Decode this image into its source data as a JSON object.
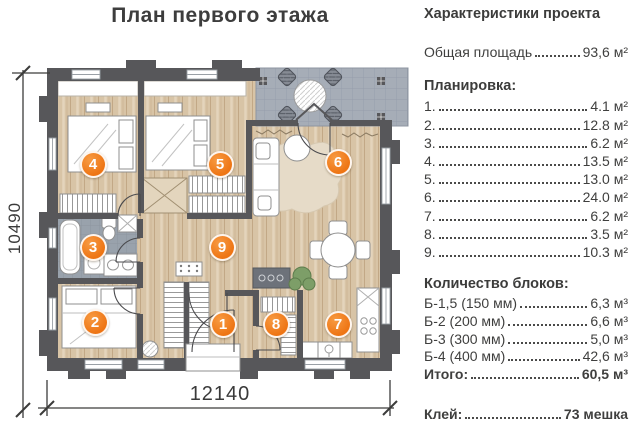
{
  "title": "План первого этажа",
  "colors": {
    "accent_orange": "#ee7b1c",
    "wall_gray": "#57575a",
    "wood_floor": "#d8c4a6",
    "tile_gray": "#9ba4ae",
    "text_dark": "#3c3c3b"
  },
  "plan": {
    "dimensions": {
      "width_label": "12140",
      "height_label": "10490"
    },
    "rooms": [
      {
        "number": "1"
      },
      {
        "number": "2"
      },
      {
        "number": "3"
      },
      {
        "number": "4"
      },
      {
        "number": "5"
      },
      {
        "number": "6"
      },
      {
        "number": "7"
      },
      {
        "number": "8"
      },
      {
        "number": "9"
      }
    ]
  },
  "panel": {
    "header": "Характеристики проекта",
    "total": {
      "label": "Общая площадь",
      "value": "93,6 м²"
    },
    "layout": {
      "header": "Планировка:",
      "items": [
        {
          "label": "1.",
          "value": "4.1 м²"
        },
        {
          "label": "2.",
          "value": "12.8 м²"
        },
        {
          "label": "3.",
          "value": "6.2 м²"
        },
        {
          "label": "4.",
          "value": "13.5 м²"
        },
        {
          "label": "5.",
          "value": "13.0 м²"
        },
        {
          "label": "6.",
          "value": "24.0 м²"
        },
        {
          "label": "7.",
          "value": "6.2 м²"
        },
        {
          "label": "8.",
          "value": "3.5 м²"
        },
        {
          "label": "9.",
          "value": "10.3 м²"
        }
      ]
    },
    "blocks": {
      "header": "Количество блоков:",
      "items": [
        {
          "label": "Б-1,5 (150 мм)",
          "value": "6,3 м³"
        },
        {
          "label": "Б-2 (200 мм)",
          "value": "6,6 м³"
        },
        {
          "label": "Б-3 (300 мм)",
          "value": "5,0 м³"
        },
        {
          "label": "Б-4 (400 мм)",
          "value": "42,6 м³"
        },
        {
          "label": "Итого:",
          "value": "60,5 м³"
        }
      ]
    },
    "glue": {
      "label": "Клей:",
      "value": "73 мешка"
    }
  }
}
